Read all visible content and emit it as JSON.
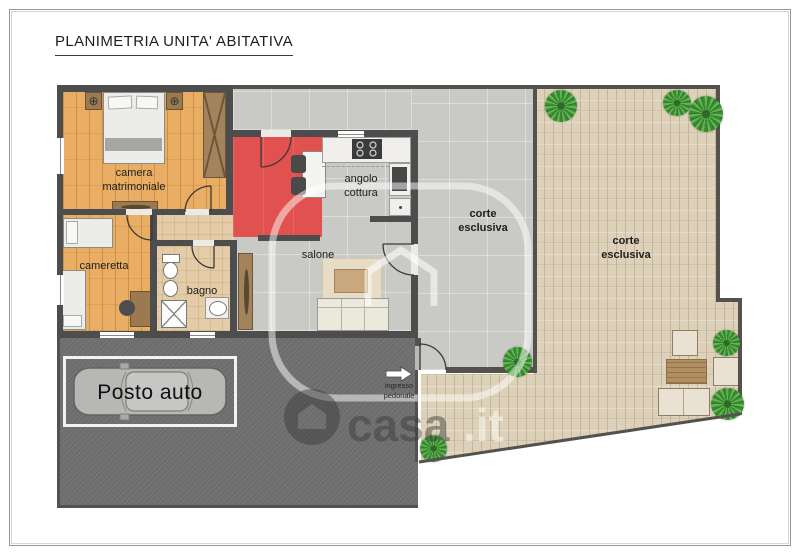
{
  "title": "PLANIMETRIA UNITA' ABITATIVA",
  "rooms": {
    "camera_matrimoniale": "camera\nmatrimoniale",
    "cameretta": "cameretta",
    "bagno": "bagno",
    "salone": "salone",
    "angolo_cottura": "angolo\ncottura"
  },
  "outdoor": {
    "corte_band": "corte\nesclusiva",
    "corte_garden": "corte\nesclusiva"
  },
  "parking": {
    "label": "Posto auto"
  },
  "entrance": {
    "label": "ingresso\npedonale"
  },
  "watermark": {
    "brand": "casa",
    "tld": ".it"
  },
  "colors": {
    "wood": "#e9ae63",
    "accent_red": "#e0514f",
    "concrete": "#c9c9c6",
    "brick": "#ddd1ba",
    "asphalt": "#6f6f6f",
    "wall": "#4d4d4d",
    "bath_floor": "#e3cca7",
    "plant_green": "#4c9b40"
  }
}
